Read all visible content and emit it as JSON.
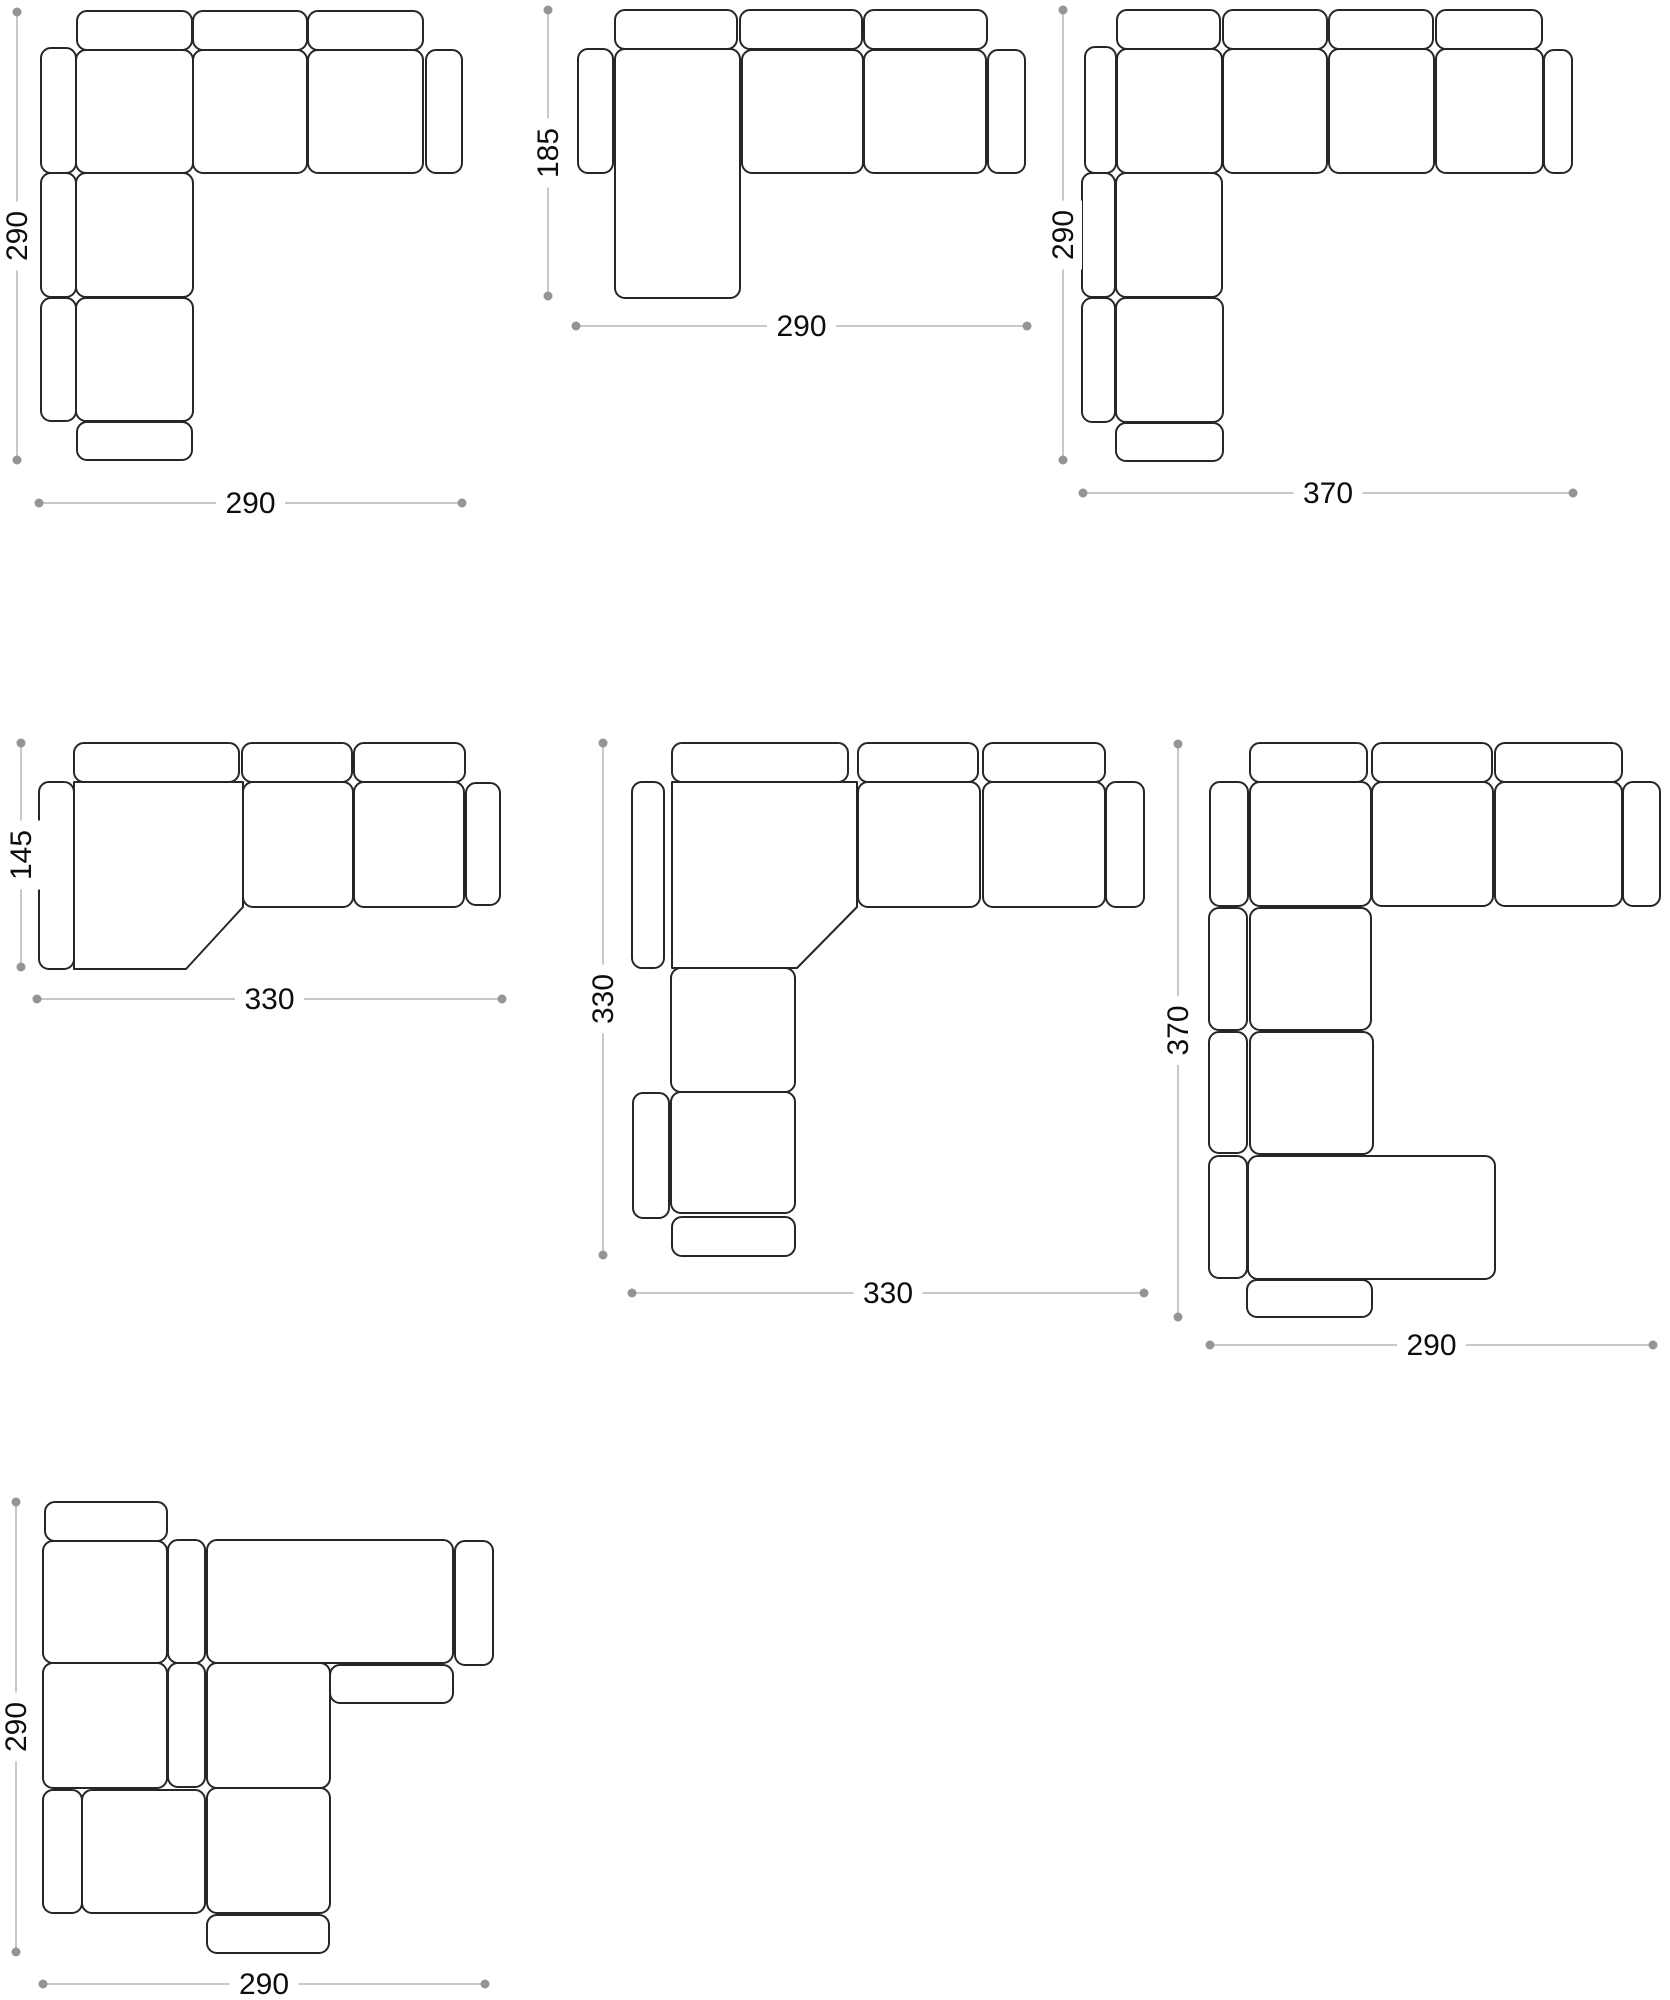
{
  "canvas": {
    "width": 1670,
    "height": 2000,
    "background": "#ffffff"
  },
  "style": {
    "outline_color": "#262626",
    "dim_line_color": "#b5b5b5",
    "dim_dot_color": "#959595",
    "dim_text_color": "#0d0d0d",
    "corner_radius": 10,
    "dim_font_size": 30
  },
  "configurations": [
    {
      "id": "c1",
      "name": "corner-sofa-290x290",
      "pieces": [
        {
          "t": "back-cushion",
          "r": [
            77,
            11,
            115,
            39
          ]
        },
        {
          "t": "back-cushion",
          "r": [
            193,
            11,
            114,
            39
          ]
        },
        {
          "t": "back-cushion",
          "r": [
            308,
            11,
            115,
            39
          ]
        },
        {
          "t": "armrest",
          "r": [
            41,
            48,
            35,
            125
          ]
        },
        {
          "t": "seat",
          "r": [
            76,
            50,
            117,
            123
          ]
        },
        {
          "t": "seat",
          "r": [
            193,
            50,
            114,
            123
          ]
        },
        {
          "t": "seat",
          "r": [
            308,
            50,
            115,
            123
          ]
        },
        {
          "t": "armrest",
          "r": [
            426,
            50,
            36,
            123
          ]
        },
        {
          "t": "armrest",
          "r": [
            41,
            173,
            35,
            124
          ]
        },
        {
          "t": "seat",
          "r": [
            76,
            173,
            117,
            124
          ]
        },
        {
          "t": "armrest",
          "r": [
            41,
            298,
            35,
            123
          ]
        },
        {
          "t": "seat",
          "r": [
            76,
            298,
            117,
            123
          ]
        },
        {
          "t": "back-cushion",
          "r": [
            77,
            422,
            115,
            38
          ]
        }
      ],
      "dims": [
        {
          "dir": "v",
          "x": 17,
          "y1": 12,
          "y2": 460,
          "label": "290"
        },
        {
          "dir": "h",
          "y": 503,
          "x1": 39,
          "x2": 462,
          "label": "290"
        }
      ]
    },
    {
      "id": "c2",
      "name": "chaise-sofa-185x290",
      "pieces": [
        {
          "t": "back-cushion",
          "r": [
            615,
            10,
            122,
            39
          ]
        },
        {
          "t": "back-cushion",
          "r": [
            740,
            10,
            122,
            39
          ]
        },
        {
          "t": "back-cushion",
          "r": [
            864,
            10,
            123,
            39
          ]
        },
        {
          "t": "armrest",
          "r": [
            578,
            49,
            35,
            124
          ]
        },
        {
          "t": "chaise",
          "r": [
            615,
            49,
            125,
            249
          ]
        },
        {
          "t": "seat",
          "r": [
            742,
            50,
            121,
            123
          ]
        },
        {
          "t": "seat",
          "r": [
            864,
            50,
            122,
            123
          ]
        },
        {
          "t": "armrest",
          "r": [
            988,
            50,
            37,
            123
          ]
        }
      ],
      "dims": [
        {
          "dir": "v",
          "x": 548,
          "y1": 10,
          "y2": 296,
          "label": "185"
        },
        {
          "dir": "h",
          "y": 326,
          "x1": 576,
          "x2": 1027,
          "label": "290"
        }
      ]
    },
    {
      "id": "c3",
      "name": "corner-sofa-290x370",
      "pieces": [
        {
          "t": "back-cushion",
          "r": [
            1117,
            10,
            103,
            39
          ]
        },
        {
          "t": "back-cushion",
          "r": [
            1223,
            10,
            104,
            39
          ]
        },
        {
          "t": "back-cushion",
          "r": [
            1329,
            10,
            104,
            39
          ]
        },
        {
          "t": "back-cushion",
          "r": [
            1436,
            10,
            106,
            39
          ]
        },
        {
          "t": "armrest",
          "r": [
            1085,
            47,
            31,
            126
          ]
        },
        {
          "t": "seat",
          "r": [
            1117,
            49,
            105,
            124
          ]
        },
        {
          "t": "seat",
          "r": [
            1223,
            49,
            104,
            124
          ]
        },
        {
          "t": "seat",
          "r": [
            1329,
            49,
            105,
            124
          ]
        },
        {
          "t": "seat",
          "r": [
            1436,
            49,
            107,
            124
          ]
        },
        {
          "t": "armrest",
          "r": [
            1544,
            50,
            28,
            123
          ]
        },
        {
          "t": "armrest",
          "r": [
            1082,
            173,
            33,
            124
          ]
        },
        {
          "t": "seat",
          "r": [
            1116,
            173,
            106,
            124
          ]
        },
        {
          "t": "armrest",
          "r": [
            1082,
            298,
            33,
            124
          ]
        },
        {
          "t": "seat",
          "r": [
            1116,
            298,
            107,
            124
          ]
        },
        {
          "t": "back-cushion",
          "r": [
            1116,
            423,
            107,
            38
          ]
        }
      ],
      "dims": [
        {
          "dir": "v",
          "x": 1063,
          "y1": 10,
          "y2": 460,
          "label": "290"
        },
        {
          "dir": "h",
          "y": 493,
          "x1": 1083,
          "x2": 1573,
          "label": "370"
        }
      ]
    },
    {
      "id": "c4",
      "name": "angled-chaise-sofa-145x330",
      "pieces": [
        {
          "t": "back-cushion",
          "r": [
            74,
            743,
            165,
            39
          ]
        },
        {
          "t": "back-cushion",
          "r": [
            242,
            743,
            110,
            39
          ]
        },
        {
          "t": "back-cushion",
          "r": [
            354,
            743,
            111,
            39
          ]
        },
        {
          "t": "armrest",
          "r": [
            39,
            782,
            35,
            187
          ]
        },
        {
          "t": "corner-seat",
          "pts": [
            [
              74,
              782
            ],
            [
              243,
              782
            ],
            [
              243,
              907
            ],
            [
              186,
              969
            ],
            [
              74,
              969
            ]
          ]
        },
        {
          "t": "seat",
          "r": [
            243,
            782,
            110,
            125
          ]
        },
        {
          "t": "seat",
          "r": [
            354,
            782,
            110,
            125
          ]
        },
        {
          "t": "armrest",
          "r": [
            466,
            783,
            34,
            122
          ]
        }
      ],
      "dims": [
        {
          "dir": "v",
          "x": 21,
          "y1": 743,
          "y2": 967,
          "label": "145"
        },
        {
          "dir": "h",
          "y": 999,
          "x1": 37,
          "x2": 502,
          "label": "330"
        }
      ]
    },
    {
      "id": "c5",
      "name": "diagonal-corner-sofa-330x330",
      "pieces": [
        {
          "t": "back-cushion",
          "r": [
            672,
            743,
            176,
            39
          ]
        },
        {
          "t": "back-cushion",
          "r": [
            858,
            743,
            120,
            39
          ]
        },
        {
          "t": "back-cushion",
          "r": [
            983,
            743,
            122,
            39
          ]
        },
        {
          "t": "armrest",
          "r": [
            632,
            782,
            32,
            186
          ]
        },
        {
          "t": "corner-seat",
          "pts": [
            [
              672,
              782
            ],
            [
              857,
              782
            ],
            [
              857,
              907
            ],
            [
              797,
              968
            ],
            [
              672,
              968
            ]
          ]
        },
        {
          "t": "seat",
          "r": [
            858,
            782,
            122,
            125
          ]
        },
        {
          "t": "seat",
          "r": [
            983,
            782,
            122,
            125
          ]
        },
        {
          "t": "armrest",
          "r": [
            1106,
            782,
            38,
            125
          ]
        },
        {
          "t": "seat",
          "r": [
            671,
            968,
            124,
            124
          ]
        },
        {
          "t": "armrest",
          "r": [
            633,
            1093,
            36,
            125
          ]
        },
        {
          "t": "seat",
          "r": [
            671,
            1092,
            124,
            121
          ]
        },
        {
          "t": "back-cushion",
          "r": [
            672,
            1217,
            123,
            39
          ]
        }
      ],
      "dims": [
        {
          "dir": "v",
          "x": 603,
          "y1": 743,
          "y2": 1255,
          "label": "330"
        },
        {
          "dir": "h",
          "y": 1293,
          "x1": 632,
          "x2": 1144,
          "label": "330"
        }
      ]
    },
    {
      "id": "c6",
      "name": "corner-sofa-with-ottoman-370x290",
      "pieces": [
        {
          "t": "back-cushion",
          "r": [
            1250,
            743,
            117,
            39
          ]
        },
        {
          "t": "back-cushion",
          "r": [
            1372,
            743,
            120,
            39
          ]
        },
        {
          "t": "back-cushion",
          "r": [
            1495,
            743,
            127,
            39
          ]
        },
        {
          "t": "armrest",
          "r": [
            1210,
            782,
            38,
            124
          ]
        },
        {
          "t": "seat",
          "r": [
            1250,
            782,
            121,
            124
          ]
        },
        {
          "t": "seat",
          "r": [
            1372,
            782,
            121,
            124
          ]
        },
        {
          "t": "seat",
          "r": [
            1495,
            782,
            127,
            124
          ]
        },
        {
          "t": "armrest",
          "r": [
            1623,
            782,
            37,
            124
          ]
        },
        {
          "t": "armrest",
          "r": [
            1209,
            908,
            38,
            122
          ]
        },
        {
          "t": "seat",
          "r": [
            1250,
            908,
            121,
            122
          ]
        },
        {
          "t": "armrest",
          "r": [
            1209,
            1032,
            38,
            121
          ]
        },
        {
          "t": "seat",
          "r": [
            1250,
            1032,
            123,
            122
          ]
        },
        {
          "t": "armrest",
          "r": [
            1209,
            1156,
            38,
            122
          ]
        },
        {
          "t": "ottoman",
          "r": [
            1248,
            1156,
            247,
            123
          ]
        },
        {
          "t": "back-cushion",
          "r": [
            1247,
            1280,
            125,
            37
          ]
        }
      ],
      "dims": [
        {
          "dir": "v",
          "x": 1178,
          "y1": 744,
          "y2": 1317,
          "label": "370"
        },
        {
          "dir": "h",
          "y": 1345,
          "x1": 1210,
          "x2": 1653,
          "label": "290"
        }
      ]
    },
    {
      "id": "c7",
      "name": "modular-corner-sofa-290x290",
      "pieces": [
        {
          "t": "back-cushion",
          "r": [
            45,
            1502,
            122,
            39
          ]
        },
        {
          "t": "seat",
          "r": [
            43,
            1541,
            124,
            122
          ]
        },
        {
          "t": "armrest",
          "r": [
            168,
            1540,
            37,
            123
          ]
        },
        {
          "t": "seat",
          "r": [
            207,
            1540,
            246,
            123
          ]
        },
        {
          "t": "armrest",
          "r": [
            455,
            1541,
            38,
            124
          ]
        },
        {
          "t": "seat",
          "r": [
            43,
            1663,
            124,
            125
          ]
        },
        {
          "t": "armrest",
          "r": [
            168,
            1663,
            37,
            124
          ]
        },
        {
          "t": "seat",
          "r": [
            207,
            1663,
            123,
            125
          ]
        },
        {
          "t": "back-cushion",
          "r": [
            330,
            1665,
            123,
            38
          ]
        },
        {
          "t": "armrest",
          "r": [
            43,
            1790,
            39,
            123
          ]
        },
        {
          "t": "seat",
          "r": [
            82,
            1790,
            123,
            123
          ]
        },
        {
          "t": "seat",
          "r": [
            207,
            1788,
            123,
            125
          ]
        },
        {
          "t": "back-cushion",
          "r": [
            207,
            1915,
            122,
            38
          ]
        }
      ],
      "dims": [
        {
          "dir": "v",
          "x": 16,
          "y1": 1502,
          "y2": 1952,
          "label": "290"
        },
        {
          "dir": "h",
          "y": 1984,
          "x1": 43,
          "x2": 485,
          "label": "290"
        }
      ]
    }
  ]
}
